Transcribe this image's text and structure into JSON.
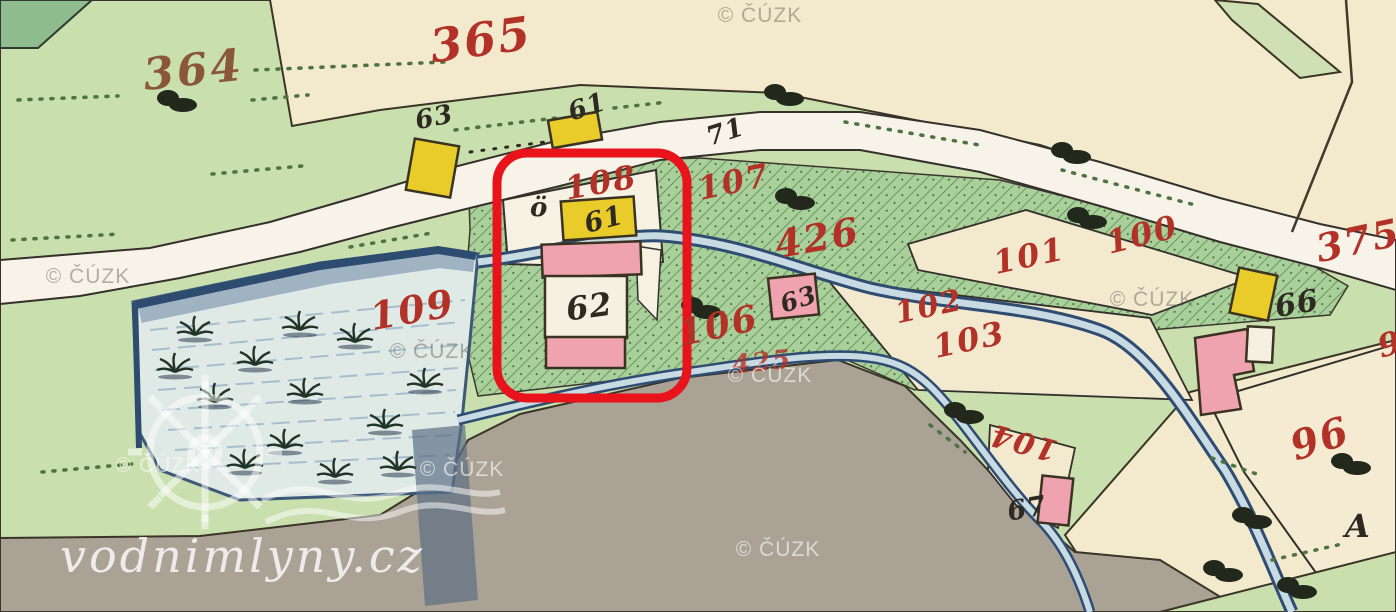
{
  "map": {
    "kind": "historical cadastral map scan",
    "highlight": "red rounded rectangle around mill buildings 61 and 62 on parcel 108"
  },
  "parcels_red": {
    "p364": "364",
    "p365": "365",
    "p375": "375",
    "p96": "96",
    "p100": "100",
    "p101": "101",
    "p102": "102",
    "p103": "103",
    "p104": "104",
    "p106": "106",
    "p107": "107",
    "p108": "108",
    "p109": "109",
    "p425": "425",
    "p426": "426",
    "p9partial": "9"
  },
  "houses_black": {
    "h63_top": "63",
    "h61_top": "61",
    "h71": "71",
    "h_o": "ö",
    "h61_mill": "61",
    "h62": "62",
    "h63_small": "63",
    "h66": "66",
    "h67": "67",
    "hA": "A"
  },
  "watermarks": {
    "cuzk": "© ČÚZK",
    "site": "vodnimlyny.cz"
  },
  "colors": {
    "parcel_number_red": "#b23227",
    "parcel_number_brown": "#8a573c",
    "house_number_black": "#2e2a22",
    "highlight_box_red": "#e8131b",
    "field_cream": "#f3e9cd",
    "meadow_green": "#c9dfae",
    "garden_hatch_green": "#a9cf9b",
    "water_blue": "#dfe9e6",
    "road_white": "#f7f3e8",
    "ground_gray": "#aaa295",
    "building_wood_yellow": "#e9cb2a",
    "building_masonry_pink": "#efa3ae"
  }
}
